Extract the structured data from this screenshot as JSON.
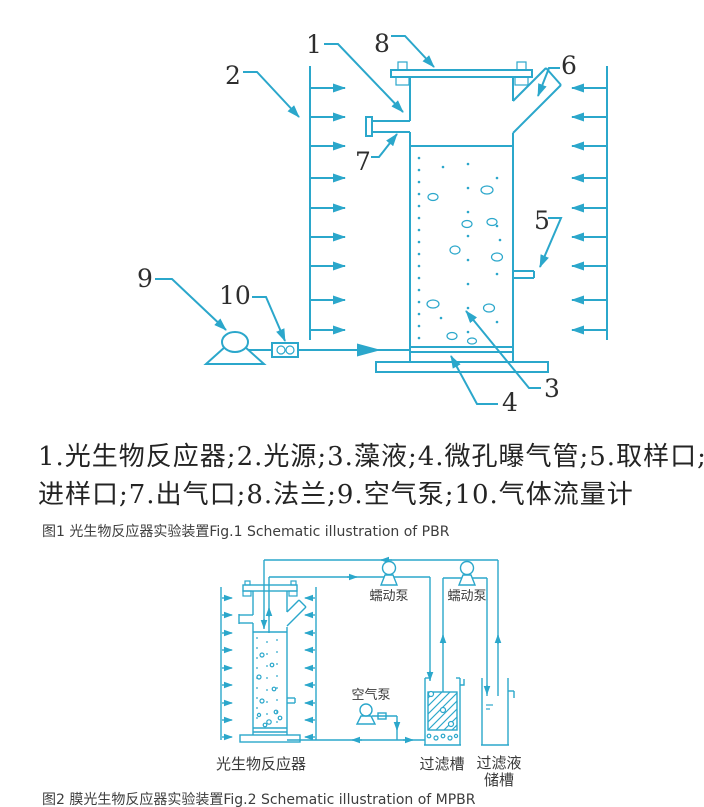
{
  "colors": {
    "diagram_line": "#2ba7cb",
    "label_text": "#2e2e2e",
    "caption_text": "#3d3d3d"
  },
  "figure1": {
    "callout_numbers": {
      "n1": "1",
      "n2": "2",
      "n3": "3",
      "n4": "4",
      "n5": "5",
      "n6": "6",
      "n7": "7",
      "n8": "8",
      "n9": "9",
      "n10": "10"
    },
    "legend_lines": [
      "1.光生物反应器;2.光源;3.藻液;4.微孔曝气管;5.取样口;6.",
      "进样口;7.出气口;8.法兰;9.空气泵;10.气体流量计"
    ],
    "caption": "图1 光生物反应器实验装置Fig.1 Schematic illustration of PBR"
  },
  "figure2": {
    "labels": {
      "pump_left": "蠕动泵",
      "pump_right": "蠕动泵",
      "air_pump": "空气泵",
      "reactor": "光生物反应器",
      "filter_tank": "过滤槽",
      "filtrate_tank_line1": "过滤液",
      "filtrate_tank_line2": "储槽"
    },
    "caption": "图2 膜光生物反应器实验装置Fig.2 Schematic illustration of MPBR"
  }
}
